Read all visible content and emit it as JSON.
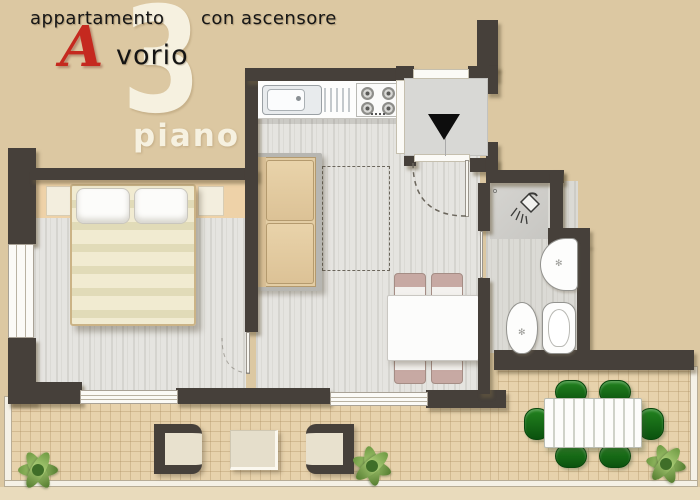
{
  "header": {
    "left": "appartamento",
    "right": "con ascensore",
    "brand_initial": "A",
    "brand_rest": "vorio",
    "floor_number": "3",
    "floor_label": "piano"
  },
  "palette": {
    "background": "#dcc8a2",
    "wall": "#46403a",
    "accent_red": "#c5291f",
    "watermark": "#f6f1e0",
    "floor": "#e5e4e0",
    "terrace": "#e7d2ac",
    "headboard": "#eed2a8",
    "sofa": "#e3cda4",
    "elevator": "#d8d8d5",
    "green_chair": "#15691a",
    "mauve_chair": "#c7a9a3"
  },
  "icons": {
    "elevator_direction": "down-triangle",
    "shower": "shower-head",
    "basin_drain": "✻"
  }
}
